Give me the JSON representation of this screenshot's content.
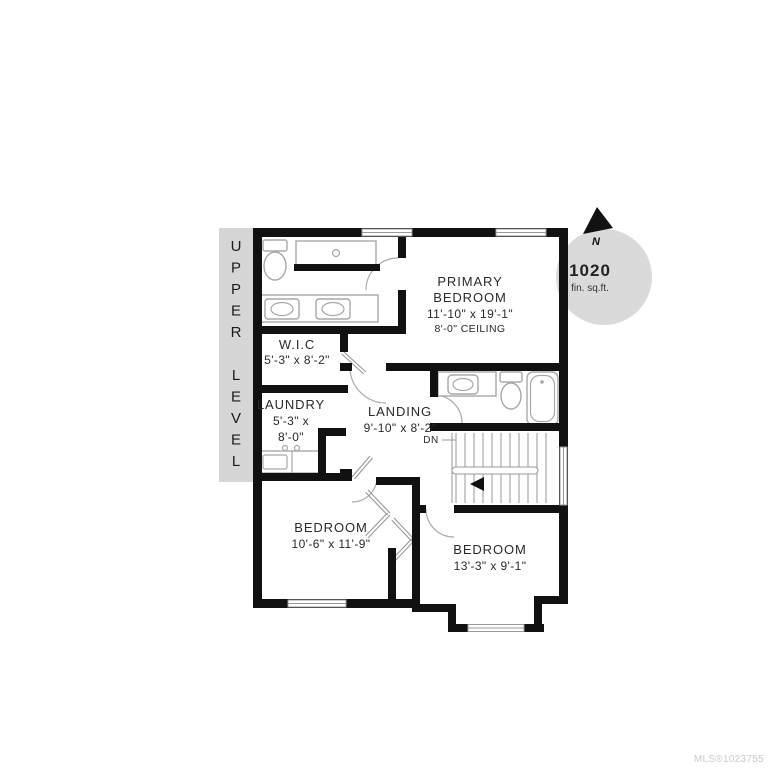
{
  "plan": {
    "level_band": {
      "label": "UPPER LEVEL",
      "bg": "#d6d6d6"
    },
    "area_badge": {
      "value": "1020",
      "unit": "fin. sq.ft.",
      "bg": "#dadada"
    },
    "north_indicator": {
      "label": "N"
    },
    "rooms": {
      "primary_bedroom": {
        "name_line1": "PRIMARY",
        "name_line2": "BEDROOM",
        "dimensions": "11'-10\" x 19'-1\"",
        "ceiling": "8'-0\" CEILING"
      },
      "wic": {
        "name": "W.I.C",
        "dimensions": "5'-3\" x 8'-2\""
      },
      "laundry": {
        "name": "LAUNDRY",
        "dimensions_line1": "5'-3\" x",
        "dimensions_line2": "8'-0\""
      },
      "landing": {
        "name": "LANDING",
        "dimensions": "9'-10\" x 8'-2\""
      },
      "bedroom_left": {
        "name": "BEDROOM",
        "dimensions": "10'-6\" x 11'-9\""
      },
      "bedroom_right": {
        "name": "BEDROOM",
        "dimensions": "13'-3\" x 9'-1\""
      }
    },
    "stairs": {
      "direction_label": "DN"
    }
  },
  "watermark": "MLS®1023755",
  "colors": {
    "wall": "#111111",
    "fixture": "#a8a8a8",
    "band": "#d6d6d6",
    "badge": "#dadada",
    "text": "#2a2a2a",
    "watermark": "#c9c9c9"
  }
}
